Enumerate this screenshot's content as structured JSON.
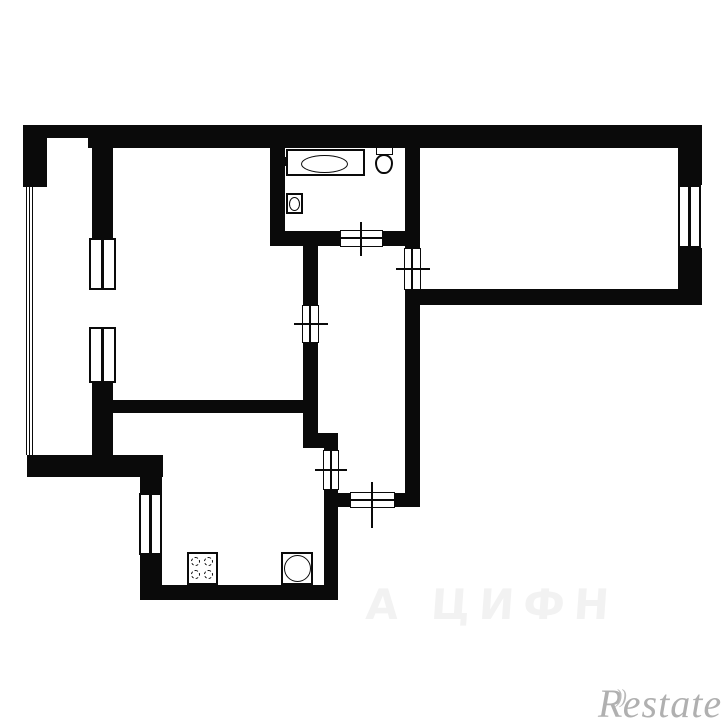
{
  "watermarks": {
    "brand_r": "R",
    "brand_arcs": "))",
    "brand_rest": "estate",
    "faint_text": "А ЦИФН"
  },
  "colors": {
    "wall": "#0a0a0a",
    "background": "#ffffff",
    "brand_gray": "#b0b0b0"
  },
  "plan": {
    "walls": [
      {
        "x": 23,
        "y": 125,
        "w": 65,
        "h": 13
      },
      {
        "x": 88,
        "y": 125,
        "w": 614,
        "h": 23
      },
      {
        "x": 23,
        "y": 125,
        "w": 24,
        "h": 62
      },
      {
        "x": 678,
        "y": 125,
        "w": 24,
        "h": 60
      },
      {
        "x": 678,
        "y": 248,
        "w": 24,
        "h": 57
      },
      {
        "x": 418,
        "y": 289,
        "w": 284,
        "h": 16
      },
      {
        "x": 92,
        "y": 138,
        "w": 21,
        "h": 100
      },
      {
        "x": 92,
        "y": 383,
        "w": 21,
        "h": 72
      },
      {
        "x": 113,
        "y": 400,
        "w": 190,
        "h": 13
      },
      {
        "x": 27,
        "y": 455,
        "w": 136,
        "h": 22
      },
      {
        "x": 140,
        "y": 477,
        "w": 22,
        "h": 16
      },
      {
        "x": 140,
        "y": 555,
        "w": 22,
        "h": 31
      },
      {
        "x": 140,
        "y": 585,
        "w": 198,
        "h": 15
      },
      {
        "x": 324,
        "y": 448,
        "w": 14,
        "h": 152
      },
      {
        "x": 303,
        "y": 245,
        "w": 15,
        "h": 203
      },
      {
        "x": 318,
        "y": 433,
        "w": 20,
        "h": 15
      },
      {
        "x": 270,
        "y": 147,
        "w": 15,
        "h": 99
      },
      {
        "x": 270,
        "y": 231,
        "w": 137,
        "h": 15
      },
      {
        "x": 405,
        "y": 145,
        "w": 15,
        "h": 362
      },
      {
        "x": 326,
        "y": 493,
        "w": 94,
        "h": 14
      }
    ],
    "windows": [
      {
        "x": 89,
        "y": 238,
        "w": 27,
        "h": 52
      },
      {
        "x": 89,
        "y": 327,
        "w": 27,
        "h": 56
      },
      {
        "x": 678,
        "y": 185,
        "w": 23,
        "h": 63
      },
      {
        "x": 139,
        "y": 493,
        "w": 23,
        "h": 62
      }
    ],
    "door_gaps": [
      {
        "x": 340,
        "y": 230,
        "w": 43,
        "h": 17
      },
      {
        "x": 404,
        "y": 248,
        "w": 17,
        "h": 42
      },
      {
        "x": 302,
        "y": 305,
        "w": 17,
        "h": 38
      },
      {
        "x": 323,
        "y": 450,
        "w": 16,
        "h": 40
      },
      {
        "x": 350,
        "y": 492,
        "w": 45,
        "h": 16
      }
    ],
    "lines": [
      {
        "n": "door-cross-line",
        "x": 360,
        "y": 222,
        "w": 2,
        "h": 34
      },
      {
        "n": "door-cross-line",
        "x": 338,
        "y": 237,
        "w": 46,
        "h": 2
      },
      {
        "n": "door-cross-line",
        "x": 396,
        "y": 268,
        "w": 34,
        "h": 2
      },
      {
        "n": "door-cross-line",
        "x": 411,
        "y": 246,
        "w": 2,
        "h": 46
      },
      {
        "n": "door-cross-line",
        "x": 294,
        "y": 323,
        "w": 34,
        "h": 2
      },
      {
        "n": "door-cross-line",
        "x": 309,
        "y": 303,
        "w": 2,
        "h": 42
      },
      {
        "n": "door-cross-line",
        "x": 315,
        "y": 469,
        "w": 32,
        "h": 2
      },
      {
        "n": "door-cross-line",
        "x": 330,
        "y": 448,
        "w": 2,
        "h": 44
      },
      {
        "n": "door-cross-line",
        "x": 371,
        "y": 482,
        "w": 2,
        "h": 46
      },
      {
        "n": "door-cross-line",
        "x": 348,
        "y": 499,
        "w": 49,
        "h": 2
      },
      {
        "n": "balcony-line",
        "x": 26,
        "y": 187,
        "w": 1,
        "h": 268
      },
      {
        "n": "balcony-line",
        "x": 29,
        "y": 187,
        "w": 1,
        "h": 268
      },
      {
        "n": "balcony-line",
        "x": 32,
        "y": 187,
        "w": 1,
        "h": 268
      },
      {
        "n": "tub-faucet-mark",
        "x": 285,
        "y": 157,
        "w": 3,
        "h": 9
      }
    ],
    "fixtures": [
      {
        "type": "bathtub",
        "x": 286,
        "y": 149,
        "w": 79,
        "h": 27
      },
      {
        "type": "toilet-tank",
        "x": 376,
        "y": 147,
        "w": 17,
        "h": 8
      },
      {
        "type": "toilet-bowl",
        "x": 375,
        "y": 154,
        "w": 18,
        "h": 20
      },
      {
        "type": "washbasin",
        "x": 286,
        "y": 193,
        "w": 17,
        "h": 21
      },
      {
        "type": "stove",
        "x": 187,
        "y": 552,
        "w": 31,
        "h": 33
      },
      {
        "type": "kitchen-sink",
        "x": 281,
        "y": 552,
        "w": 32,
        "h": 33
      }
    ]
  }
}
